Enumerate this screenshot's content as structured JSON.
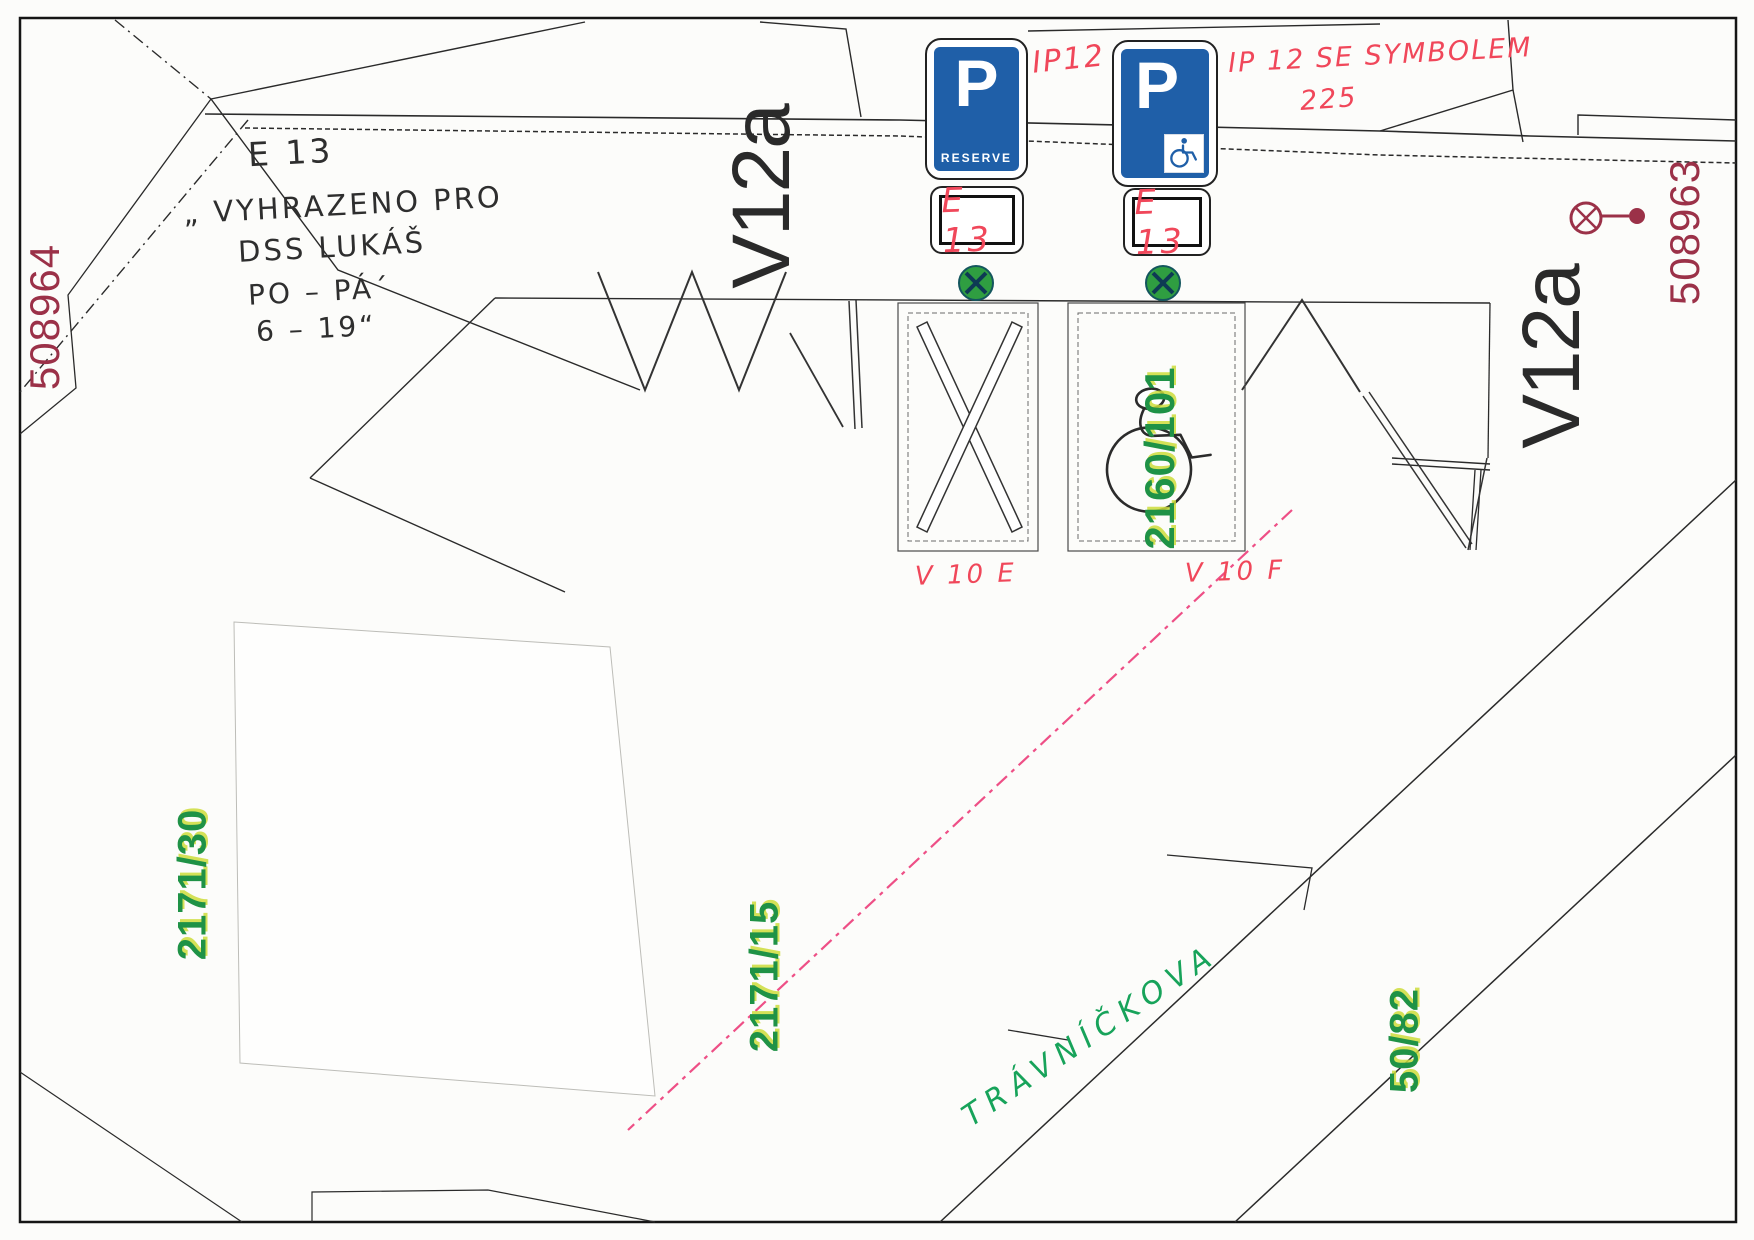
{
  "note": {
    "line1": "E 13",
    "line2": "„ VYHRAZENO PRO",
    "line3": "DSS LUKÁŠ",
    "line4": "PO – PÁ´",
    "line5": "6 – 19“"
  },
  "signs": {
    "ip12": {
      "p": "P",
      "caption": "RESERVE",
      "annotation": "IP12"
    },
    "ip12_symbol": {
      "p": "P",
      "annotation_line1": "IP 12 SE SYMBOLEM",
      "annotation_line2": "225"
    }
  },
  "plates": {
    "left": "E 13",
    "right": "E 13"
  },
  "markings": {
    "v12a_left": "V12a",
    "v12a_right": "V12a",
    "v10e": "V 10 E",
    "v10f": "V 10 F"
  },
  "parcels": {
    "survey_left": "508964",
    "survey_right": "508963",
    "p2171_30": "2171/30",
    "p2171_15": "2171/15",
    "p2160_101": "2160/101",
    "p50_82": "50/82"
  },
  "street": {
    "name": "TRÁVNÍČKOVA"
  },
  "colors": {
    "sign_blue": "#1f5fa8",
    "post_green": "#2f9e41",
    "annotation_red": "#f0475a",
    "parcel_green": "#1f9246",
    "boundary_pink": "#ee4f86",
    "survey_maroon": "#9b3148"
  }
}
